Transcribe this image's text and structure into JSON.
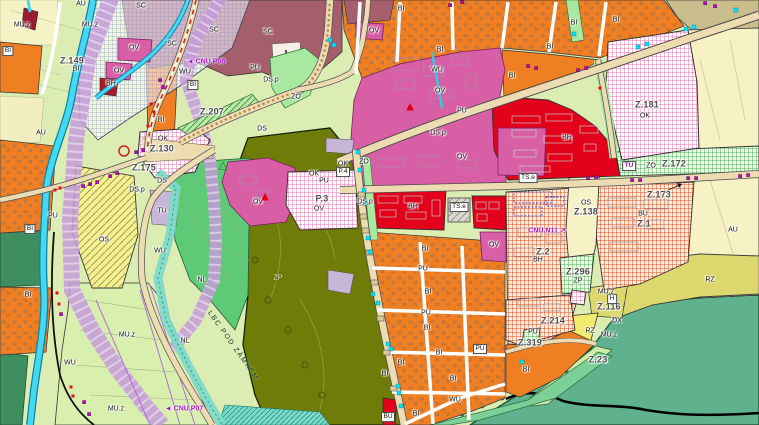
{
  "map": {
    "kind": "municipal-zoning-plan",
    "legend_colors": {
      "orange_bi": "#f07f23",
      "magenta_ov": "#d85fa6",
      "red_bh": "#e2001a",
      "maroon_sc": "#a55e6b",
      "olive_zp": "#6f7c08",
      "green_nl": "#5ec977",
      "seagreen_nature": "#5fb28d",
      "yellow_os": "#f6f188",
      "pale_au": "#f6f2c6",
      "fields_mu": "#d9efae",
      "river": "#45d8f0",
      "violet_corridor": "#c49ad8",
      "road": "#eddcb2",
      "purple_marker": "#c800d0",
      "cyan_marker": "#00e4f8",
      "red_marker": "#e01010"
    },
    "labels": [
      {
        "t": "Z.149",
        "x": 72,
        "y": 61,
        "c": "plan"
      },
      {
        "t": "Z.207",
        "x": 212,
        "y": 112,
        "c": "plan"
      },
      {
        "t": "Z.130",
        "x": 162,
        "y": 149,
        "c": "plan"
      },
      {
        "t": "Z.175",
        "x": 144,
        "y": 168,
        "c": "plan"
      },
      {
        "t": "Z.181",
        "x": 647,
        "y": 105,
        "c": "plan"
      },
      {
        "t": "Z.172",
        "x": 674,
        "y": 164,
        "c": "plan"
      },
      {
        "t": "Z.173",
        "x": 659,
        "y": 195,
        "c": "plan"
      },
      {
        "t": "Z.1",
        "x": 644,
        "y": 224,
        "c": "plan"
      },
      {
        "t": "Z.2",
        "x": 543,
        "y": 252,
        "c": "plan"
      },
      {
        "t": "Z.138",
        "x": 586,
        "y": 212,
        "c": "plan"
      },
      {
        "t": "Z.296",
        "x": 578,
        "y": 272,
        "c": "plan"
      },
      {
        "t": "Z.214",
        "x": 553,
        "y": 321,
        "c": "plan"
      },
      {
        "t": "Z.319",
        "x": 530,
        "y": 343,
        "c": "plan"
      },
      {
        "t": "Z.116",
        "x": 609,
        "y": 307,
        "c": "plan"
      },
      {
        "t": "Z.23",
        "x": 598,
        "y": 360,
        "c": "plan"
      },
      {
        "t": "P.3",
        "x": 322,
        "y": 199,
        "c": "plan"
      },
      {
        "t": "P.4",
        "x": 343,
        "y": 172,
        "c": "box"
      },
      {
        "t": "TU",
        "x": 629,
        "y": 166,
        "c": "boxp"
      },
      {
        "t": "TS.e",
        "x": 459,
        "y": 207,
        "c": "box"
      },
      {
        "t": "TS.e",
        "x": 528,
        "y": 178,
        "c": "box"
      },
      {
        "t": "PU",
        "x": 480,
        "y": 349,
        "c": "box"
      },
      {
        "t": "BI",
        "x": 8,
        "y": 51,
        "c": "box"
      },
      {
        "t": "BI",
        "x": 193,
        "y": 85,
        "c": "box"
      },
      {
        "t": "BI",
        "x": 30,
        "y": 229,
        "c": "box"
      },
      {
        "t": "H",
        "x": 612,
        "y": 299,
        "c": "box"
      },
      {
        "t": "BU",
        "x": 388,
        "y": 417,
        "c": "box"
      },
      {
        "t": "AU",
        "x": 81,
        "y": 4,
        "c": "zone"
      },
      {
        "t": "AU",
        "x": 41,
        "y": 133,
        "c": "zone"
      },
      {
        "t": "AU",
        "x": 733,
        "y": 230,
        "c": "zone"
      },
      {
        "t": "MU.z",
        "x": 22,
        "y": 25,
        "c": "zone"
      },
      {
        "t": "MU.z",
        "x": 90,
        "y": 25,
        "c": "zone"
      },
      {
        "t": "MU.z",
        "x": 127,
        "y": 335,
        "c": "zone"
      },
      {
        "t": "MU.z",
        "x": 116,
        "y": 409,
        "c": "zone"
      },
      {
        "t": "MU.z",
        "x": 606,
        "y": 292,
        "c": "zone"
      },
      {
        "t": "MU.z",
        "x": 609,
        "y": 335,
        "c": "zone"
      },
      {
        "t": "BI",
        "x": 76,
        "y": 69,
        "c": "zone"
      },
      {
        "t": "BI",
        "x": 161,
        "y": 120,
        "c": "zone"
      },
      {
        "t": "BI",
        "x": 28,
        "y": 295,
        "c": "zone"
      },
      {
        "t": "BI",
        "x": 401,
        "y": 9,
        "c": "zone"
      },
      {
        "t": "BI",
        "x": 440,
        "y": 50,
        "c": "zone"
      },
      {
        "t": "BI",
        "x": 550,
        "y": 47,
        "c": "zone"
      },
      {
        "t": "BI",
        "x": 574,
        "y": 23,
        "c": "zone"
      },
      {
        "t": "BI",
        "x": 616,
        "y": 20,
        "c": "zone"
      },
      {
        "t": "BI",
        "x": 512,
        "y": 76,
        "c": "zone"
      },
      {
        "t": "BI",
        "x": 425,
        "y": 249,
        "c": "zone"
      },
      {
        "t": "BI",
        "x": 428,
        "y": 292,
        "c": "zone"
      },
      {
        "t": "BI",
        "x": 427,
        "y": 328,
        "c": "zone"
      },
      {
        "t": "BI",
        "x": 439,
        "y": 353,
        "c": "zone"
      },
      {
        "t": "BI",
        "x": 401,
        "y": 363,
        "c": "zone"
      },
      {
        "t": "BI",
        "x": 453,
        "y": 379,
        "c": "zone"
      },
      {
        "t": "BI",
        "x": 385,
        "y": 374,
        "c": "zone"
      },
      {
        "t": "BI",
        "x": 416,
        "y": 414,
        "c": "zone"
      },
      {
        "t": "BI",
        "x": 526,
        "y": 370,
        "c": "zone"
      },
      {
        "t": "SC",
        "x": 141,
        "y": 6,
        "c": "zone"
      },
      {
        "t": "SC",
        "x": 172,
        "y": 44,
        "c": "zone"
      },
      {
        "t": "SC",
        "x": 214,
        "y": 30,
        "c": "zone"
      },
      {
        "t": "SC",
        "x": 268,
        "y": 32,
        "c": "zone"
      },
      {
        "t": "OV",
        "x": 134,
        "y": 48,
        "c": "zone"
      },
      {
        "t": "OV",
        "x": 119,
        "y": 71,
        "c": "zone"
      },
      {
        "t": "OV",
        "x": 374,
        "y": 31,
        "c": "zone"
      },
      {
        "t": "OV",
        "x": 440,
        "y": 91,
        "c": "zone"
      },
      {
        "t": "OV",
        "x": 462,
        "y": 157,
        "c": "zone"
      },
      {
        "t": "OV",
        "x": 258,
        "y": 202,
        "c": "zone"
      },
      {
        "t": "OV",
        "x": 319,
        "y": 209,
        "c": "zone"
      },
      {
        "t": "OV",
        "x": 494,
        "y": 245,
        "c": "zone"
      },
      {
        "t": "BH",
        "x": 111,
        "y": 84,
        "c": "zone"
      },
      {
        "t": "BH",
        "x": 567,
        "y": 138,
        "c": "zone"
      },
      {
        "t": "BH",
        "x": 413,
        "y": 207,
        "c": "zone"
      },
      {
        "t": "BH",
        "x": 538,
        "y": 260,
        "c": "zone"
      },
      {
        "t": "BU",
        "x": 643,
        "y": 214,
        "c": "zone"
      },
      {
        "t": "OK",
        "x": 163,
        "y": 139,
        "c": "zone"
      },
      {
        "t": "OK",
        "x": 314,
        "y": 174,
        "c": "zone"
      },
      {
        "t": "OK",
        "x": 343,
        "y": 164,
        "c": "zone"
      },
      {
        "t": "OK",
        "x": 645,
        "y": 116,
        "c": "zone"
      },
      {
        "t": "OS",
        "x": 104,
        "y": 240,
        "c": "zone"
      },
      {
        "t": "OS",
        "x": 586,
        "y": 203,
        "c": "zone"
      },
      {
        "t": "PU",
        "x": 255,
        "y": 68,
        "c": "zone"
      },
      {
        "t": "PU",
        "x": 53,
        "y": 216,
        "c": "zone"
      },
      {
        "t": "PU",
        "x": 324,
        "y": 181,
        "c": "zone"
      },
      {
        "t": "PU",
        "x": 423,
        "y": 269,
        "c": "zone"
      },
      {
        "t": "PU",
        "x": 426,
        "y": 313,
        "c": "zone"
      },
      {
        "t": "PU",
        "x": 462,
        "y": 111,
        "c": "zone"
      },
      {
        "t": "PU",
        "x": 533,
        "y": 332,
        "c": "zone"
      },
      {
        "t": "DS",
        "x": 162,
        "y": 181,
        "c": "zone"
      },
      {
        "t": "DS",
        "x": 262,
        "y": 129,
        "c": "zone"
      },
      {
        "t": "DS.p",
        "x": 271,
        "y": 80,
        "c": "zone"
      },
      {
        "t": "DS.p",
        "x": 137,
        "y": 190,
        "c": "zone"
      },
      {
        "t": "DS.p",
        "x": 365,
        "y": 202,
        "c": "zone"
      },
      {
        "t": "DS.p",
        "x": 438,
        "y": 133,
        "c": "zone"
      },
      {
        "t": "ZO",
        "x": 296,
        "y": 97,
        "c": "zone"
      },
      {
        "t": "ZO",
        "x": 364,
        "y": 162,
        "c": "zone"
      },
      {
        "t": "ZO",
        "x": 651,
        "y": 166,
        "c": "zone"
      },
      {
        "t": "WU",
        "x": 185,
        "y": 72,
        "c": "zone"
      },
      {
        "t": "WU",
        "x": 437,
        "y": 70,
        "c": "zone"
      },
      {
        "t": "WU",
        "x": 160,
        "y": 251,
        "c": "zone"
      },
      {
        "t": "WU",
        "x": 70,
        "y": 363,
        "c": "zone"
      },
      {
        "t": "WU",
        "x": 455,
        "y": 400,
        "c": "zone"
      },
      {
        "t": "NL",
        "x": 202,
        "y": 280,
        "c": "zone"
      },
      {
        "t": "NL",
        "x": 185,
        "y": 341,
        "c": "zone"
      },
      {
        "t": "ZP",
        "x": 278,
        "y": 277,
        "c": "white"
      },
      {
        "t": "ZP",
        "x": 578,
        "y": 281,
        "c": "zone"
      },
      {
        "t": "TU",
        "x": 162,
        "y": 211,
        "c": "zone"
      },
      {
        "t": "RZ",
        "x": 710,
        "y": 280,
        "c": "zone"
      },
      {
        "t": "RZ",
        "x": 590,
        "y": 331,
        "c": "zone"
      },
      {
        "t": "DX",
        "x": 617,
        "y": 321,
        "c": "zone"
      },
      {
        "t": "◄ CNU.P08",
        "x": 206,
        "y": 62,
        "c": "purple"
      },
      {
        "t": "◄ CNU.P07",
        "x": 184,
        "y": 409,
        "c": "purple"
      },
      {
        "t": "CNU.N11 ↗",
        "x": 547,
        "y": 231,
        "c": "purple"
      },
      {
        "t": "LBC POD ZÁMKEM",
        "x": 233,
        "y": 346,
        "c": "lbc",
        "r": 55
      },
      {
        "t": "▲",
        "x": 410,
        "y": 106,
        "c": "tri-red"
      },
      {
        "t": "▲",
        "x": 265,
        "y": 196,
        "c": "tri-red"
      },
      {
        "t": "△",
        "x": 223,
        "y": 166,
        "c": "tri-green"
      }
    ]
  }
}
